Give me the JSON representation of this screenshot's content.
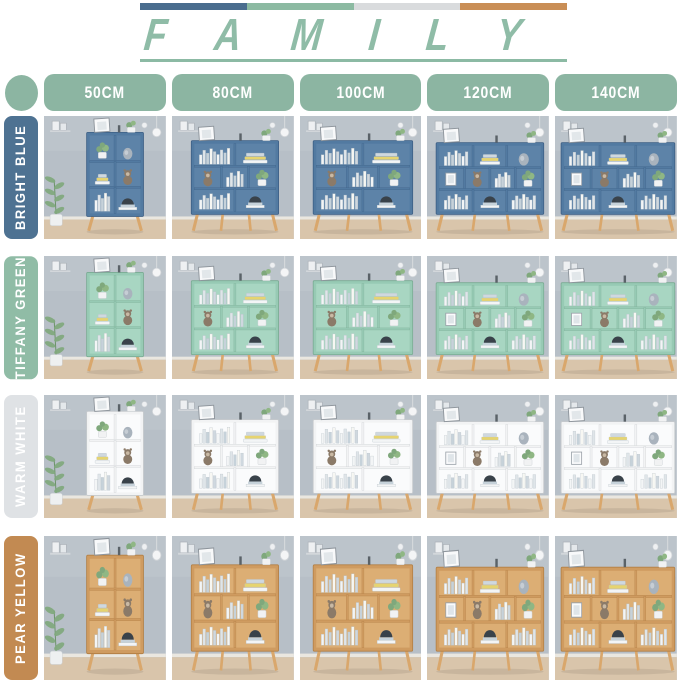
{
  "header": {
    "title_letters": [
      "F",
      "A",
      "M",
      "I",
      "L",
      "Y"
    ],
    "title_color": "#8fbca7",
    "underline_color": "#8cbaa4",
    "bar_colors": [
      "#4a6d8e",
      "#8cbaa2",
      "#d9dbdd",
      "#c98e56"
    ]
  },
  "size_header": {
    "pill_color": "#8cb5a2",
    "pill_text_color": "#ffffff",
    "sizes": [
      "50CM",
      "80CM",
      "100CM",
      "120CM",
      "140CM"
    ]
  },
  "rows": [
    {
      "key": "bright-blue",
      "label": "BRIGHT BLUE",
      "label_bg": "#4e7292",
      "shelf": "#527aa1",
      "shelf_dark": "#3d5f85",
      "shelf_back": "#5d83a8"
    },
    {
      "key": "tiffany-green",
      "label": "TIFFANY GREEN",
      "label_bg": "#90bca6",
      "shelf": "#97cab4",
      "shelf_dark": "#7aab93",
      "shelf_back": "#a8d6c2"
    },
    {
      "key": "warm-white",
      "label": "WARM WHITE",
      "label_bg": "#dfe2e5",
      "shelf": "#f2f3f4",
      "shelf_dark": "#c6cacd",
      "shelf_back": "#fafbfc"
    },
    {
      "key": "pear-yellow",
      "label": "PEAR YELLOW",
      "label_bg": "#c28a52",
      "shelf": "#cf9b60",
      "shelf_dark": "#b27f45",
      "shelf_back": "#dcae74"
    }
  ],
  "scene": {
    "wall": "#b7bfc7",
    "wall_light": "#c3cad1",
    "floor": "#d9c5ab",
    "baseboard": "#eae7e0",
    "leg": "#d9a76c",
    "plant_green": "#7fa87c",
    "accent_yellow": "#e6d470",
    "book_colors": [
      "#f3f5f6",
      "#dfe5e9",
      "#c6d2da",
      "#f7f7f3",
      "#cfd8df"
    ],
    "vase": "#a9b3bd",
    "doll": "#8b7a68",
    "hat": "#39424a",
    "pot": "#f1f2f3"
  }
}
